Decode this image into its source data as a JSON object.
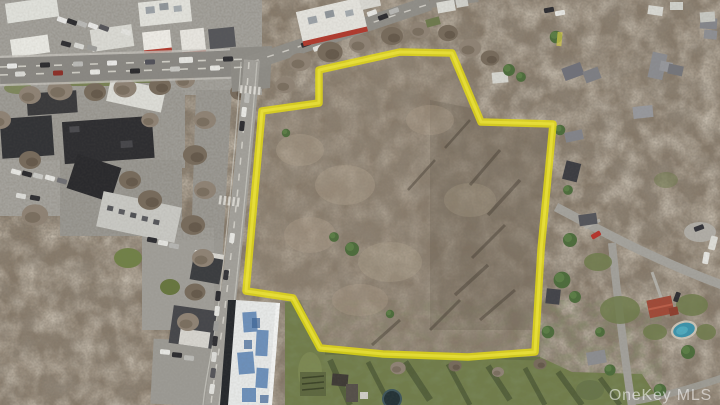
{
  "photo": {
    "kind": "aerial drone photograph",
    "subject": "Wooded land parcel outlined with a yellow property boundary, commercial corridor and roads to the left, residential streets and houses to the right, grass field below",
    "season_cue": "leafless winter trees"
  },
  "boundary": {
    "color": "#e4da12",
    "points": "262,111 319,103 319,70 400,52 452,53 481,122 553,124 541,250 535,352 468,357 383,354 320,348 293,298 246,291"
  },
  "watermark": {
    "text": "OneKey MLS"
  },
  "palette": {
    "bare_canopy": "#877a6a",
    "pavement": "#a3a19b",
    "asphalt_road": "#8a8883",
    "grass_field": "#717d4b",
    "pool_water": "#3d93ab",
    "blue_roof_patches": "#4f7bb0",
    "red_roof": "#a04a38"
  }
}
